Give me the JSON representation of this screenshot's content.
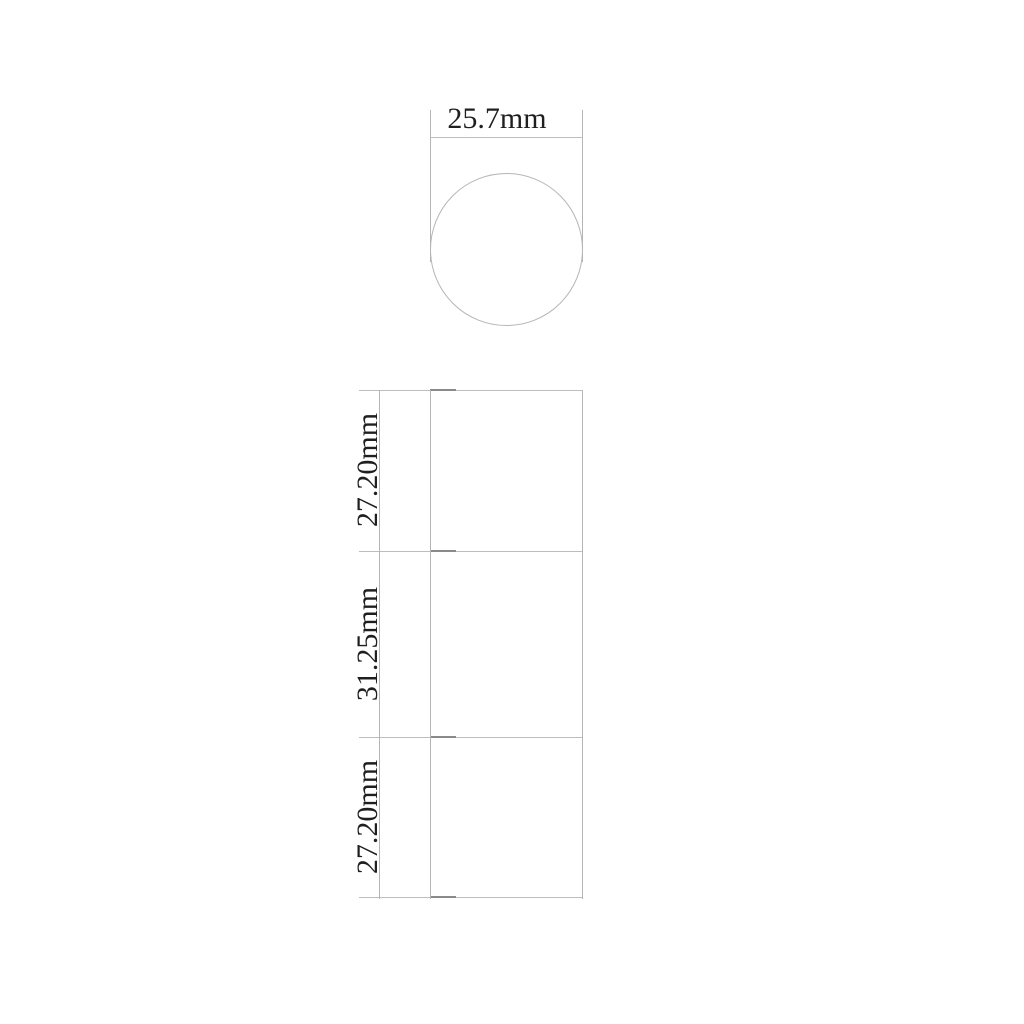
{
  "drawing": {
    "type": "technical-dimension-drawing",
    "top_view": {
      "shape": "circle",
      "diameter_label": "25.7mm",
      "diameter_mm": 25.7
    },
    "front_view": {
      "shape": "stacked-rectangles",
      "sections": [
        {
          "label": "27.20mm",
          "height_mm": 27.2
        },
        {
          "label": "31.25mm",
          "height_mm": 31.25
        },
        {
          "label": "27.20mm",
          "height_mm": 27.2
        }
      ]
    },
    "colors": {
      "line": "#b5b5b5",
      "line_dark": "#8a8a8a",
      "text": "#1f1f1f",
      "background": "#ffffff"
    }
  }
}
